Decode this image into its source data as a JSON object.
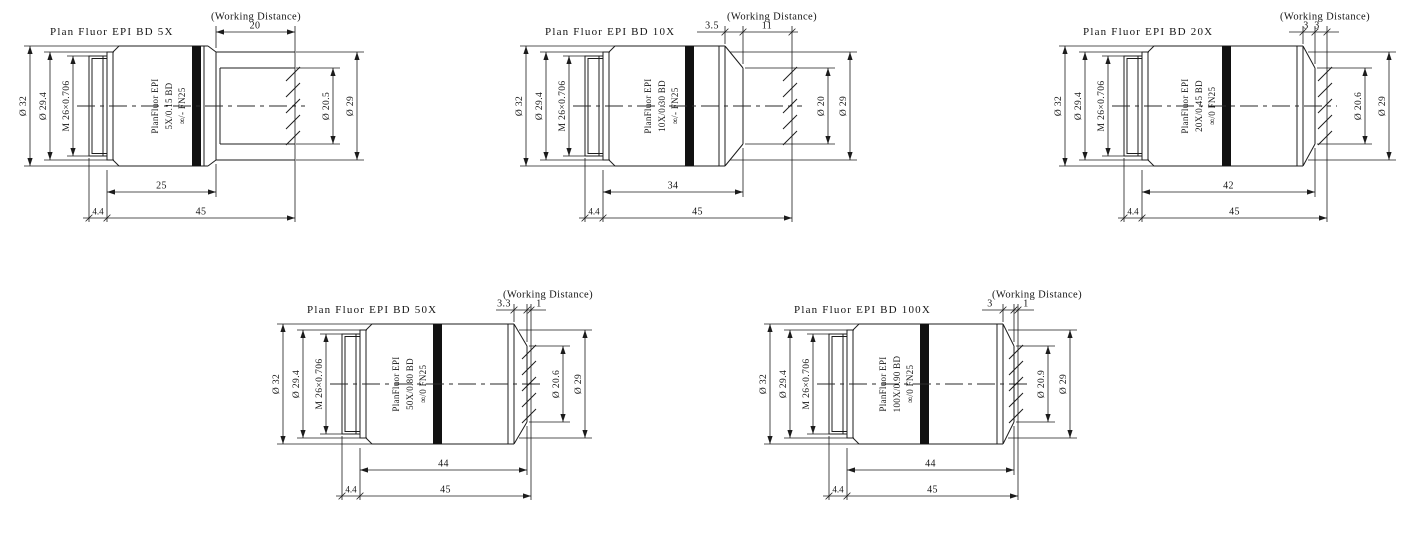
{
  "figure": {
    "background_color": "#ffffff",
    "line_color": "#1c1c1c"
  },
  "shared": {
    "working_distance_label": "(Working Distance)",
    "outer_dia_label": "Ø 32",
    "mount_flange_dia_label": "Ø 29.4",
    "thread_spec_label": "M 26×0.706",
    "snout_dia_label": "Ø 29"
  },
  "objectives": [
    {
      "title": "Plan Fluor EPI  BD 5X",
      "marking_lines": [
        "PlanFluor EPI",
        "5X/0.15 BD",
        "∞/- FN25"
      ],
      "bore_dia_label": "Ø 20.5",
      "top_dims": [
        "20"
      ],
      "bottom_dims": [
        "25",
        "4.4",
        "45"
      ]
    },
    {
      "title": "Plan Fluor EPI  BD 10X",
      "marking_lines": [
        "PlanFluor EPI",
        "10X/0.30 BD",
        "∞/- FN25"
      ],
      "bore_dia_label": "Ø 20",
      "top_dims": [
        "3.5",
        "11"
      ],
      "bottom_dims": [
        "34",
        "4.4",
        "45"
      ]
    },
    {
      "title": "Plan Fluor EPI  BD 20X",
      "marking_lines": [
        "PlanFluor EPI",
        "20X/0.45 BD",
        "∞/0 FN25"
      ],
      "bore_dia_label": "Ø 20.6",
      "top_dims": [
        "3",
        "3"
      ],
      "bottom_dims": [
        "42",
        "4.4",
        "45"
      ]
    },
    {
      "title": "Plan Fluor EPI  BD 50X",
      "marking_lines": [
        "PlanFluor EPI",
        "50X/0.80 BD",
        "∞/0 FN25"
      ],
      "bore_dia_label": "Ø 20.6",
      "top_dims": [
        "3.3",
        "1"
      ],
      "bottom_dims": [
        "44",
        "4.4",
        "45"
      ]
    },
    {
      "title": "Plan Fluor EPI  BD 100X",
      "marking_lines": [
        "PlanFluor EPI",
        "100X/0.90 BD",
        "∞/0 FN25"
      ],
      "bore_dia_label": "Ø 20.9",
      "top_dims": [
        "3",
        "1"
      ],
      "bottom_dims": [
        "44",
        "4.4",
        "45"
      ]
    }
  ]
}
